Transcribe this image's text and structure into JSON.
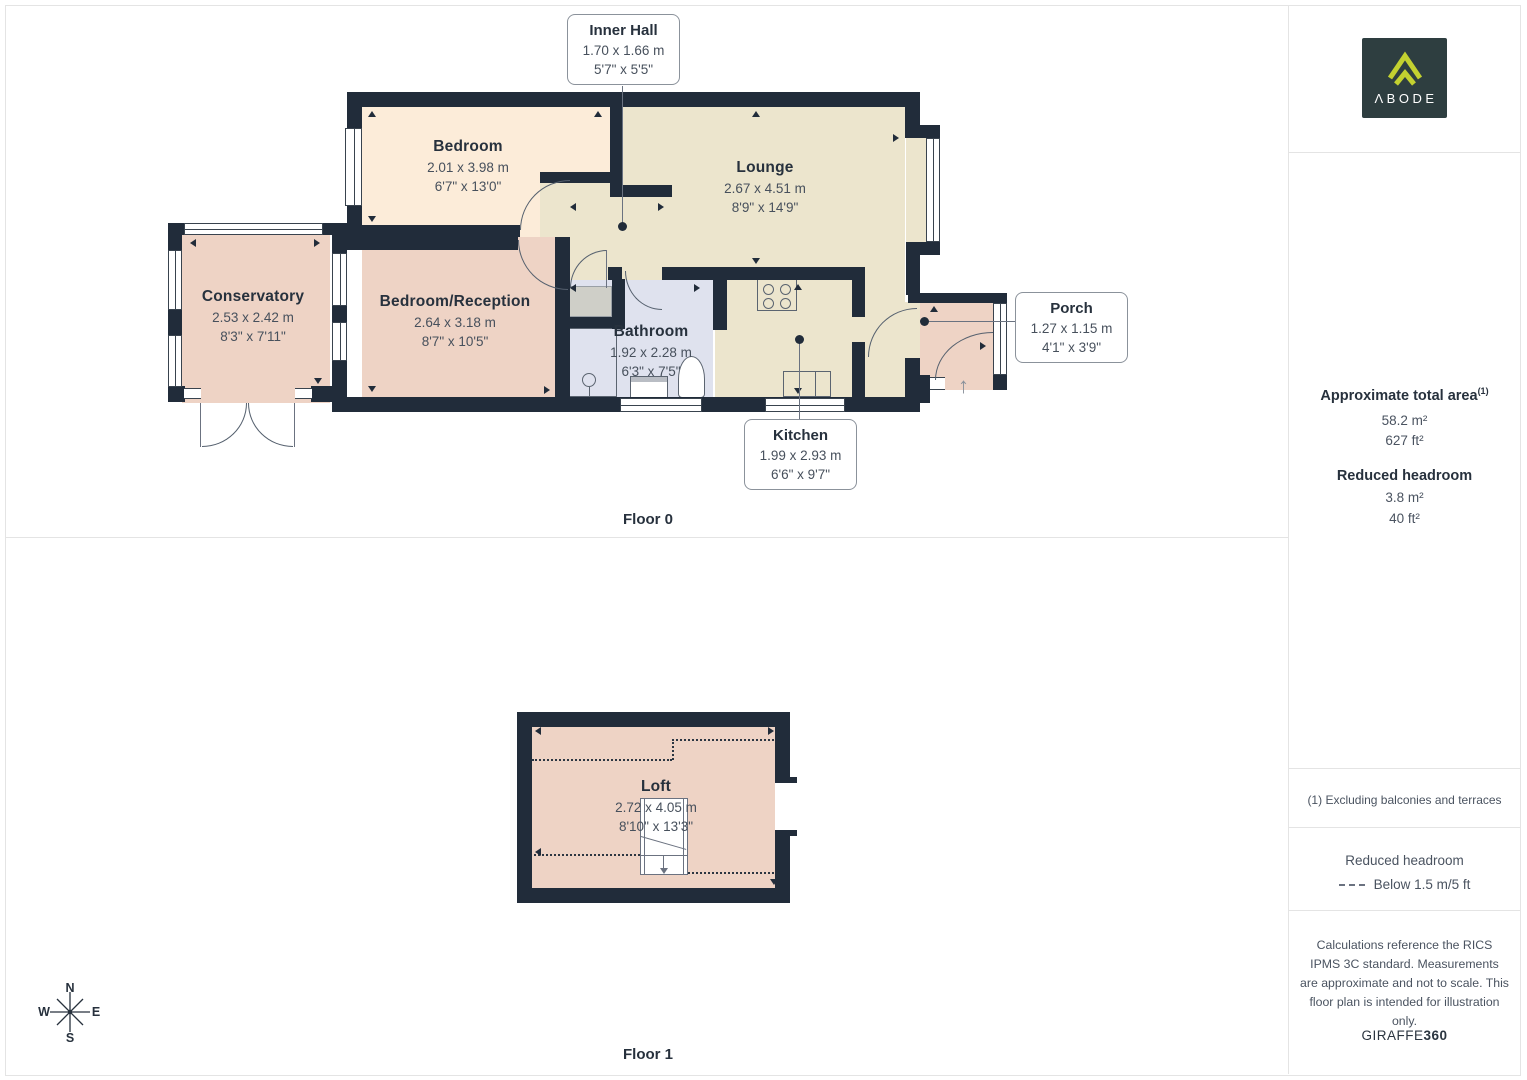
{
  "floors": {
    "f0": {
      "label": "Floor 0"
    },
    "f1": {
      "label": "Floor 1"
    }
  },
  "rooms": {
    "bedroom": {
      "name": "Bedroom",
      "m": "2.01 x 3.98 m",
      "ft": "6'7\" x 13'0\""
    },
    "lounge": {
      "name": "Lounge",
      "m": "2.67 x 4.51 m",
      "ft": "8'9\" x 14'9\""
    },
    "conservatory": {
      "name": "Conservatory",
      "m": "2.53 x 2.42 m",
      "ft": "8'3\" x 7'11\""
    },
    "bedroom_reception": {
      "name": "Bedroom/Reception",
      "m": "2.64 x 3.18 m",
      "ft": "8'7\" x 10'5\""
    },
    "bathroom": {
      "name": "Bathroom",
      "m": "1.92 x 2.28 m",
      "ft": "6'3\" x 7'5\""
    },
    "inner_hall": {
      "name": "Inner Hall",
      "m": "1.70 x 1.66 m",
      "ft": "5'7\" x 5'5\""
    },
    "kitchen": {
      "name": "Kitchen",
      "m": "1.99 x 2.93 m",
      "ft": "6'6\" x 9'7\""
    },
    "porch": {
      "name": "Porch",
      "m": "1.27 x 1.15 m",
      "ft": "4'1\" x 3'9\""
    },
    "loft": {
      "name": "Loft",
      "m": "2.72 x 4.05 m",
      "ft": "8'10\" x 13'3\""
    }
  },
  "compass": {
    "n": "N",
    "e": "E",
    "s": "S",
    "w": "W"
  },
  "sidebar": {
    "logo_text": "ΛBODE",
    "area_title": "Approximate total area",
    "area_sup": "(1)",
    "area_m2": "58.2 m²",
    "area_ft2": "627 ft²",
    "rh_title": "Reduced headroom",
    "rh_m2": "3.8 m²",
    "rh_ft2": "40 ft²",
    "note": "(1) Excluding balconies and terraces",
    "legend_title": "Reduced headroom",
    "legend_item": "Below 1.5 m/5 ft",
    "disclaimer": "Calculations reference the RICS IPMS 3C standard. Measurements are approximate and not to scale. This floor plan is intended for illustration only.",
    "brand_a": "GIRAFFE",
    "brand_b": "360"
  },
  "colors": {
    "wall": "#212c3a",
    "bedroom_fill": "#fcecd9",
    "living_fill": "#ece5cd",
    "pink_fill": "#eed3c5",
    "bathroom_fill": "#dfe2ee",
    "logo_bg": "#2e3e40",
    "logo_mark": "#c3d130"
  }
}
